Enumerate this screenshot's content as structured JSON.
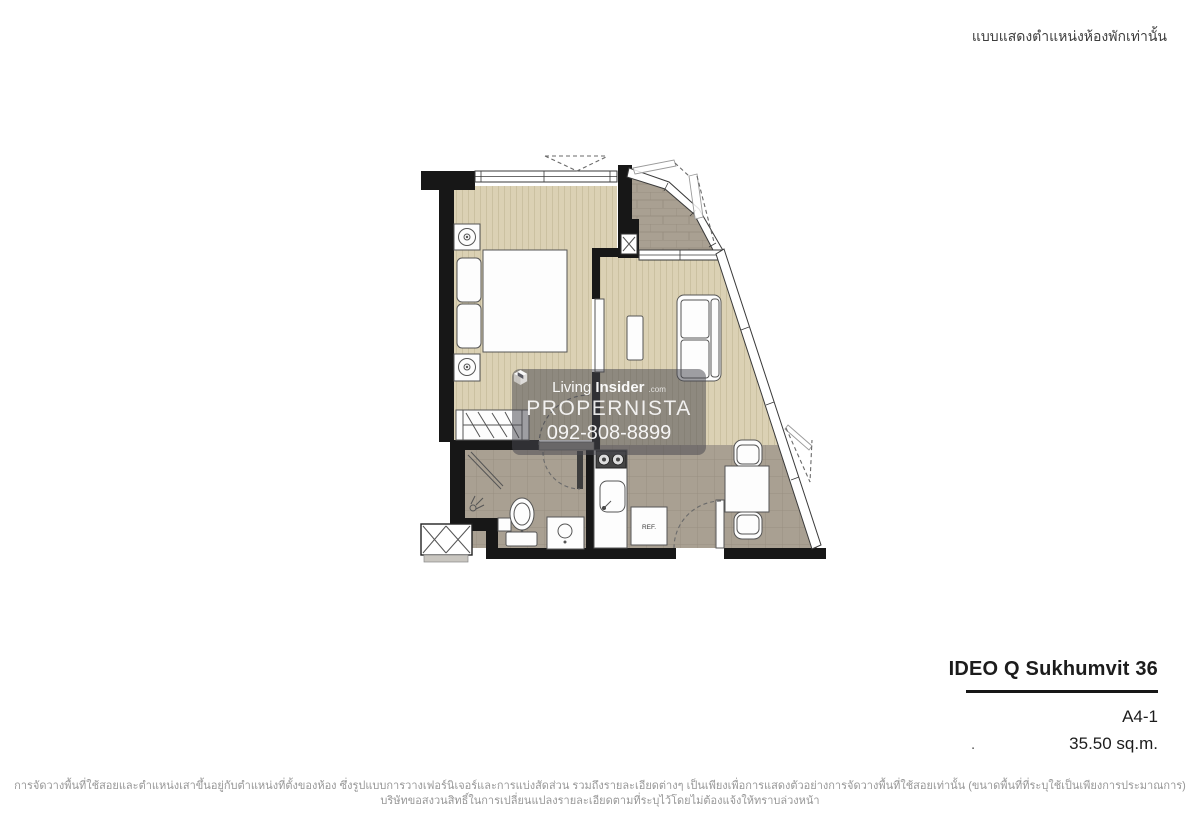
{
  "header": {
    "location_note": "แบบแสดงตำแหน่งห้องพักเท่านั้น"
  },
  "watermark": {
    "logo_light": "Living",
    "logo_bold": "Insider",
    "logo_suffix": ".com",
    "name": "PROPERNISTA",
    "phone": "092-808-8899"
  },
  "floorplan": {
    "fridge_label": "REF."
  },
  "unit_info": {
    "project_name": "IDEO Q Sukhumvit 36",
    "unit_type": "A4-1",
    "unit_area": "35.50 sq.m.",
    "stray_mark": "."
  },
  "disclaimer": {
    "line1": "การจัดวางพื้นที่ใช้สอยและตำแหน่งเสาขึ้นอยู่กับตำแหน่งที่ตั้งของห้อง ซึ่งรูปแบบการวางเฟอร์นิเจอร์และการแบ่งสัดส่วน รวมถึงรายละเอียดต่างๆ เป็นเพียงเพื่อการแสดงตัวอย่างการจัดวางพื้นที่ใช้สอยเท่านั้น (ขนาดพื้นที่ที่ระบุใช้เป็นเพียงการประมาณการ)",
    "line2": "บริษัทขอสงวนสิทธิ์ในการเปลี่ยนแปลงรายละเอียดตามที่ระบุไว้โดยไม่ต้องแจ้งให้ทราบล่วงหน้า"
  },
  "colors": {
    "wall": "#171717",
    "wood_floor": "#dbd1b4",
    "wood_line": "#cbc1a1",
    "tile_floor": "#a9a092",
    "tile_line": "#998f81",
    "furniture": "#fdfdfd",
    "outline": "#555555",
    "watermark_bg": "rgba(70,70,78,0.52)",
    "watermark_text": "#ffffff",
    "title_text": "#1c1c1c",
    "disclaimer_text": "#979797"
  }
}
